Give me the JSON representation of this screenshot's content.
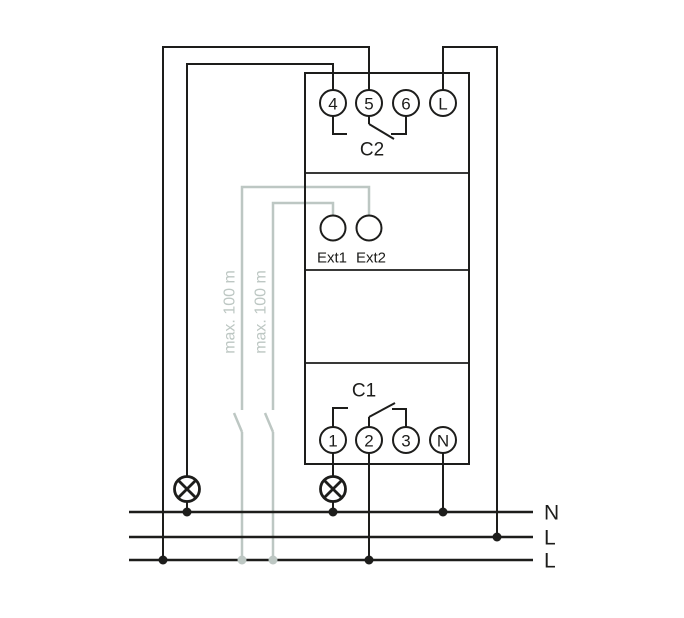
{
  "diagram": {
    "type": "wiring-diagram",
    "device": {
      "top_terminals": [
        "4",
        "5",
        "6",
        "L"
      ],
      "top_contact_label": "C2",
      "ext_inputs": [
        "Ext1",
        "Ext2"
      ],
      "bottom_contact_label": "C1",
      "bottom_terminals": [
        "1",
        "2",
        "3",
        "N"
      ]
    },
    "supply_lines": [
      "N",
      "L",
      "L"
    ],
    "cable_notes": [
      "max. 100 m",
      "max. 100 m"
    ],
    "colors": {
      "wire": "#1d1d1b",
      "aux_wire": "#bdc7c3",
      "background": "#ffffff"
    }
  }
}
